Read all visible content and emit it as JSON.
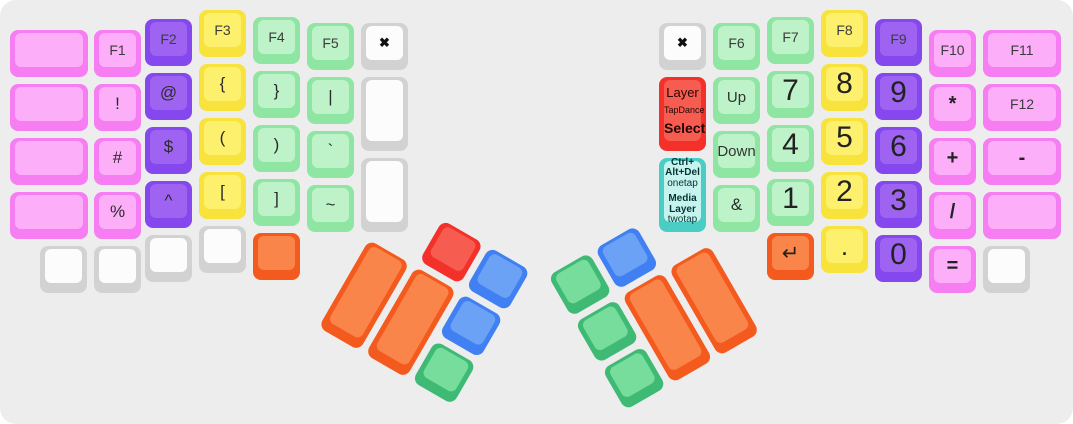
{
  "app": {
    "description_label": "split-keyboard-keymap-visualization"
  },
  "colors": {
    "background": "#ededed",
    "palette": {
      "pink": {
        "side": "#f67ef2",
        "face": "#fcaef9"
      },
      "purple": {
        "side": "#8448ee",
        "face": "#9f63f2"
      },
      "yellow": {
        "side": "#f8e23c",
        "face": "#fcf06c"
      },
      "green": {
        "side": "#8fe5a2",
        "face": "#bef3c9"
      },
      "white": {
        "side": "#d2d2d2",
        "face": "#fcfcfc"
      },
      "orange": {
        "side": "#f45a1d",
        "face": "#f9854a"
      },
      "red": {
        "side": "#f4302a",
        "face": "#f75c51"
      },
      "blue": {
        "side": "#4080f2",
        "face": "#6ba2f6"
      },
      "dgreen": {
        "side": "#3fba74",
        "face": "#76dd9c"
      },
      "cyan": {
        "side": "#49cdc4",
        "face": "#c6f3ee"
      }
    }
  },
  "keys": [
    {
      "name": "key-left-outer-r0",
      "color": "pink",
      "x": 10,
      "y": 30,
      "w": 78
    },
    {
      "name": "key-left-outer-r1",
      "color": "pink",
      "x": 10,
      "y": 84,
      "w": 78
    },
    {
      "name": "key-left-outer-r2",
      "color": "pink",
      "x": 10,
      "y": 138,
      "w": 78
    },
    {
      "name": "key-left-outer-r3",
      "color": "pink",
      "x": 10,
      "y": 192,
      "w": 78
    },
    {
      "name": "key-f1",
      "label": "F1",
      "cls": "fkey",
      "color": "pink",
      "x": 94,
      "y": 30
    },
    {
      "name": "key-exclam",
      "label": "!",
      "cls": "sym",
      "color": "pink",
      "x": 94,
      "y": 84
    },
    {
      "name": "key-hash",
      "label": "#",
      "cls": "sym",
      "color": "pink",
      "x": 94,
      "y": 138
    },
    {
      "name": "key-percent",
      "label": "%",
      "cls": "sym",
      "color": "pink",
      "x": 94,
      "y": 192
    },
    {
      "name": "key-f2",
      "label": "F2",
      "cls": "fkey",
      "color": "purple",
      "x": 145,
      "y": 19
    },
    {
      "name": "key-at",
      "label": "@",
      "cls": "sym",
      "color": "purple",
      "x": 145,
      "y": 73
    },
    {
      "name": "key-dollar",
      "label": "$",
      "cls": "sym",
      "color": "purple",
      "x": 145,
      "y": 127
    },
    {
      "name": "key-caret",
      "label": "^",
      "cls": "sym",
      "color": "purple",
      "x": 145,
      "y": 181
    },
    {
      "name": "key-f3",
      "label": "F3",
      "cls": "fkey",
      "color": "yellow",
      "x": 199,
      "y": 10
    },
    {
      "name": "key-lbrace",
      "label": "{",
      "cls": "sym",
      "color": "yellow",
      "x": 199,
      "y": 64
    },
    {
      "name": "key-lparen",
      "label": "(",
      "cls": "sym",
      "color": "yellow",
      "x": 199,
      "y": 118
    },
    {
      "name": "key-lbracket",
      "label": "[",
      "cls": "sym",
      "color": "yellow",
      "x": 199,
      "y": 172
    },
    {
      "name": "key-f4",
      "label": "F4",
      "cls": "fkey",
      "color": "green",
      "x": 253,
      "y": 17
    },
    {
      "name": "key-rbrace",
      "label": "}",
      "cls": "sym",
      "color": "green",
      "x": 253,
      "y": 71
    },
    {
      "name": "key-rparen",
      "label": ")",
      "cls": "sym",
      "color": "green",
      "x": 253,
      "y": 125
    },
    {
      "name": "key-rbracket",
      "label": "]",
      "cls": "sym",
      "color": "green",
      "x": 253,
      "y": 179
    },
    {
      "name": "key-f5",
      "label": "F5",
      "cls": "fkey",
      "color": "green",
      "x": 307,
      "y": 23
    },
    {
      "name": "key-pipe",
      "label": "|",
      "cls": "sym",
      "color": "green",
      "x": 307,
      "y": 77
    },
    {
      "name": "key-backtick",
      "label": "`",
      "cls": "sym",
      "color": "green",
      "x": 307,
      "y": 131
    },
    {
      "name": "key-tilde",
      "label": "~",
      "cls": "sym",
      "color": "green",
      "x": 307,
      "y": 185
    },
    {
      "name": "key-left-cancel",
      "label": "✖",
      "cls": "xmark",
      "color": "white",
      "x": 361,
      "y": 23
    },
    {
      "name": "key-left-inner-tall-1",
      "color": "white",
      "x": 361,
      "y": 77,
      "h": 74
    },
    {
      "name": "key-left-inner-tall-2",
      "color": "white",
      "x": 361,
      "y": 158,
      "h": 74
    },
    {
      "name": "key-left-bottom-1",
      "color": "white",
      "x": 40,
      "y": 246
    },
    {
      "name": "key-left-bottom-2",
      "color": "white",
      "x": 94,
      "y": 246
    },
    {
      "name": "key-left-bottom-3",
      "color": "white",
      "x": 145,
      "y": 235
    },
    {
      "name": "key-left-bottom-4",
      "color": "white",
      "x": 199,
      "y": 226
    },
    {
      "name": "key-left-bottom-orange",
      "color": "orange",
      "x": 253,
      "y": 233
    },
    {
      "name": "key-right-cancel",
      "label": "✖",
      "cls": "xmark",
      "color": "white",
      "x": 659,
      "y": 23
    },
    {
      "name": "key-layer-tapdance-select",
      "color": "red",
      "x": 659,
      "y": 77,
      "h": 74,
      "lines": [
        {
          "text": "Layer",
          "cls": "l-md"
        },
        {
          "text": "TapDance",
          "cls": "l-xs"
        },
        {
          "text": "Select",
          "cls": "l-md l-bold"
        }
      ]
    },
    {
      "name": "key-ctrl-alt-del-media-layer",
      "color": "cyan",
      "x": 659,
      "y": 158,
      "h": 74,
      "tight": true,
      "lines": [
        {
          "text": "Ctrl+",
          "cls": "l-cb"
        },
        {
          "text": "Alt+Del",
          "cls": "l-cb"
        },
        {
          "text": "onetap",
          "cls": "l-cr"
        },
        {
          "text": "Media",
          "cls": "l-cb l-gap"
        },
        {
          "text": "Layer",
          "cls": "l-cb"
        },
        {
          "text": "twotap",
          "cls": "l-cr"
        }
      ]
    },
    {
      "name": "key-f6",
      "label": "F6",
      "cls": "fkey",
      "color": "green",
      "x": 713,
      "y": 23
    },
    {
      "name": "key-up",
      "label": "Up",
      "cls": "word",
      "color": "green",
      "x": 713,
      "y": 77
    },
    {
      "name": "key-down",
      "label": "Down",
      "cls": "word",
      "color": "green",
      "x": 713,
      "y": 131
    },
    {
      "name": "key-ampersand",
      "label": "&",
      "cls": "sym",
      "color": "green",
      "x": 713,
      "y": 185
    },
    {
      "name": "key-f7",
      "label": "F7",
      "cls": "fkey",
      "color": "green",
      "x": 767,
      "y": 17
    },
    {
      "name": "key-num-7",
      "label": "7",
      "cls": "num",
      "color": "green",
      "x": 767,
      "y": 71
    },
    {
      "name": "key-num-4",
      "label": "4",
      "cls": "num",
      "color": "green",
      "x": 767,
      "y": 125
    },
    {
      "name": "key-num-1",
      "label": "1",
      "cls": "num",
      "color": "green",
      "x": 767,
      "y": 179
    },
    {
      "name": "key-enter",
      "label": "↵",
      "cls": "enter",
      "color": "orange",
      "x": 767,
      "y": 233
    },
    {
      "name": "key-f8",
      "label": "F8",
      "cls": "fkey",
      "color": "yellow",
      "x": 821,
      "y": 10
    },
    {
      "name": "key-num-8",
      "label": "8",
      "cls": "num",
      "color": "yellow",
      "x": 821,
      "y": 64
    },
    {
      "name": "key-num-5",
      "label": "5",
      "cls": "num",
      "color": "yellow",
      "x": 821,
      "y": 118
    },
    {
      "name": "key-num-2",
      "label": "2",
      "cls": "num",
      "color": "yellow",
      "x": 821,
      "y": 172
    },
    {
      "name": "key-period",
      "label": ".",
      "cls": "dot",
      "color": "yellow",
      "x": 821,
      "y": 226
    },
    {
      "name": "key-f9",
      "label": "F9",
      "cls": "fkey",
      "color": "purple",
      "x": 875,
      "y": 19
    },
    {
      "name": "key-num-9",
      "label": "9",
      "cls": "num",
      "color": "purple",
      "x": 875,
      "y": 73
    },
    {
      "name": "key-num-6",
      "label": "6",
      "cls": "num",
      "color": "purple",
      "x": 875,
      "y": 127
    },
    {
      "name": "key-num-3",
      "label": "3",
      "cls": "num",
      "color": "purple",
      "x": 875,
      "y": 181
    },
    {
      "name": "key-num-0",
      "label": "0",
      "cls": "num",
      "color": "purple",
      "x": 875,
      "y": 235
    },
    {
      "name": "key-f10",
      "label": "F10",
      "cls": "fkey",
      "color": "pink",
      "x": 929,
      "y": 30
    },
    {
      "name": "key-asterisk",
      "label": "*",
      "cls": "op",
      "color": "pink",
      "x": 929,
      "y": 84
    },
    {
      "name": "key-plus",
      "label": "+",
      "cls": "op",
      "color": "pink",
      "x": 929,
      "y": 138
    },
    {
      "name": "key-slash",
      "label": "/",
      "cls": "op",
      "color": "pink",
      "x": 929,
      "y": 192
    },
    {
      "name": "key-equals",
      "label": "=",
      "cls": "op",
      "color": "pink",
      "x": 929,
      "y": 246
    },
    {
      "name": "key-f11",
      "label": "F11",
      "cls": "fkey",
      "color": "pink",
      "x": 983,
      "y": 30,
      "w": 78
    },
    {
      "name": "key-f12",
      "label": "F12",
      "cls": "fkey",
      "color": "pink",
      "x": 983,
      "y": 84,
      "w": 78
    },
    {
      "name": "key-minus",
      "label": "-",
      "cls": "op",
      "color": "pink",
      "x": 983,
      "y": 138,
      "w": 78
    },
    {
      "name": "key-right-outer-blank",
      "color": "pink",
      "x": 983,
      "y": 192,
      "w": 78
    },
    {
      "name": "key-right-bottom-white",
      "color": "white",
      "x": 983,
      "y": 246
    },
    {
      "name": "thumb-left-red",
      "color": "red",
      "x": 54,
      "y": 0,
      "group": "thumb-left"
    },
    {
      "name": "thumb-left-blue-top",
      "color": "blue",
      "x": 108,
      "y": 0,
      "group": "thumb-left"
    },
    {
      "name": "thumb-left-blue-mid",
      "color": "blue",
      "x": 108,
      "y": 54,
      "group": "thumb-left"
    },
    {
      "name": "thumb-left-green",
      "color": "dgreen",
      "x": 108,
      "y": 108,
      "group": "thumb-left"
    },
    {
      "name": "thumb-left-orange-1",
      "color": "orange",
      "x": 0,
      "y": 54,
      "h": 101,
      "group": "thumb-left"
    },
    {
      "name": "thumb-left-orange-2",
      "color": "orange",
      "x": 54,
      "y": 54,
      "h": 101,
      "group": "thumb-left"
    },
    {
      "name": "thumb-right-green-top",
      "color": "dgreen",
      "x": 0,
      "y": 0,
      "group": "thumb-right"
    },
    {
      "name": "thumb-right-green-mid",
      "color": "dgreen",
      "x": 0,
      "y": 54,
      "group": "thumb-right"
    },
    {
      "name": "thumb-right-green-bottom",
      "color": "dgreen",
      "x": 0,
      "y": 108,
      "group": "thumb-right"
    },
    {
      "name": "thumb-right-blue",
      "color": "blue",
      "x": 54,
      "y": 0,
      "group": "thumb-right"
    },
    {
      "name": "thumb-right-orange-1",
      "color": "orange",
      "x": 54,
      "y": 54,
      "h": 101,
      "group": "thumb-right"
    },
    {
      "name": "thumb-right-orange-2",
      "color": "orange",
      "x": 108,
      "y": 54,
      "h": 101,
      "group": "thumb-right"
    }
  ]
}
